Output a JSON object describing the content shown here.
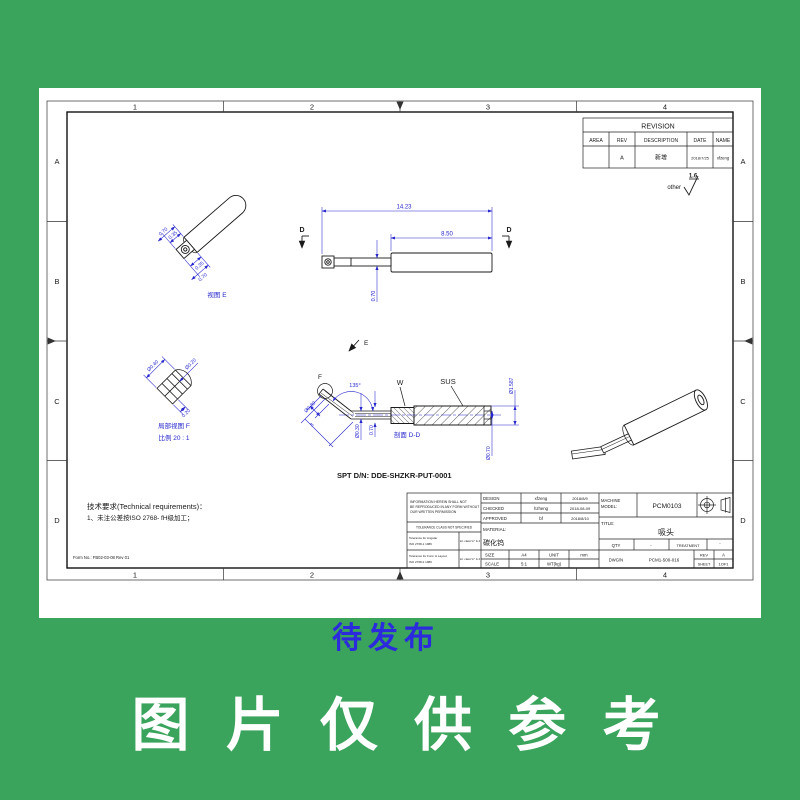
{
  "colors": {
    "background_green": "#3aa35c",
    "dimension_blue": "#2626cc",
    "stamp_blue": "#2b2bdd"
  },
  "banner": {
    "text": "图 片 仅 供 参 考"
  },
  "sheet": {
    "zones_top": [
      "1",
      "2",
      "3",
      "4"
    ],
    "zones_bottom": [
      "1",
      "2",
      "3",
      "4"
    ],
    "zones_left": [
      "A",
      "B",
      "C",
      "D"
    ],
    "zones_right": [
      "A",
      "B",
      "C",
      "D"
    ]
  },
  "revision_table": {
    "title": "REVISION",
    "headers": [
      "AREA",
      "REV",
      "DESCRIPTION",
      "DATE",
      "NAME"
    ],
    "row": {
      "area": "",
      "rev": "A",
      "description": "新增",
      "date": "2018/7/25",
      "name": "xfzeng"
    }
  },
  "roughness": {
    "prefix": "other",
    "value": "1.6"
  },
  "view_e": {
    "label": "视图 E",
    "dim_a": "0.35",
    "dim_b": "0.70",
    "dim_c": "0.35",
    "dim_d": "0.70"
  },
  "main_view": {
    "dim_overall": "14.23",
    "dim_body": "8.50",
    "dim_height": "0.70",
    "section_letter_left": "D",
    "section_letter_right": "D"
  },
  "detail_f": {
    "label": "局部视图 F",
    "scale": "比例 20 : 1",
    "dim1": "Ø0.40",
    "dim2": "0.20",
    "dim3": "Ø0.20"
  },
  "section_dd": {
    "label": "剖面 D-D",
    "angle": "135°",
    "dim_tip_dia": "Ø0.30",
    "dim_tip_len": "3",
    "dim_shaft_dia": "Ø0.30",
    "dim_shaft_od": "0.70",
    "dim_body_od": "Ø1.587",
    "dim_bore": "Ø0.70",
    "label_w": "W",
    "label_sus": "SUS",
    "label_f": "F",
    "label_e": "E"
  },
  "notes": {
    "spt": "SPT D/N: DDE-SHZKR-PUT-0001",
    "tech_title": "技术要求(Technical requirements)：",
    "tech_item": "1、未注公差按ISO 2768- fH级加工；",
    "stamp": "待发布",
    "form_no": "Form No.:  FB02-03-08  Rev 01"
  },
  "title_block": {
    "disclaimer1": "INFORMATION HEREIN SHALL NOT",
    "disclaimer2": "BE REPRODUCED IN ANY FORM WITHOUT",
    "disclaimer3": "OUR WRITTEN PERMISSION",
    "tol_header": "TOLERANCE CLASS NOT SPECIFIED",
    "tol1_line1": "Tolerance for Angular",
    "tol1_line2": "ISO 2768-1 1989",
    "tol1_class": "tol. class\"m\" & 4",
    "tol2_line1": "Tolerance for Form & Layout",
    "tol2_line2": "ISO 2768-2 1989",
    "tol2_class": "tol. class\"m\" & 4",
    "design_label": "DESIGN",
    "design_name": "xfzeng",
    "design_date": "2018/8/9",
    "checked_label": "CHECKED",
    "checked_name": "hzheng",
    "checked_date": "2018-08-09",
    "approved_label": "APPROVED",
    "approved_name": "bf",
    "approved_date": "2018/8/10",
    "material_label": "MATERIAL:",
    "material_value": "碳化钨",
    "machine_label1": "MACHINE",
    "machine_label2": "MODEL:",
    "machine_value": "PCM0103",
    "title_label": "TITLE:",
    "title_value": "吸头",
    "qty_label": "QTY",
    "qty_value": "-",
    "treatment_label": "TREATMENT",
    "treatment_value": "-",
    "size_label": "SIZE",
    "size_value": "A4",
    "unit_label": "UNIT",
    "unit_value": "mm",
    "scale_label": "SCALE",
    "scale_value": "5:1",
    "wt_label": "WT(kg)",
    "dwg_label": "DWG/N",
    "dwg_value": "PCM1-500-016",
    "rev_label": "REV",
    "rev_value": "A",
    "sheet_label": "SHEET",
    "sheet_value": "1OF1"
  }
}
